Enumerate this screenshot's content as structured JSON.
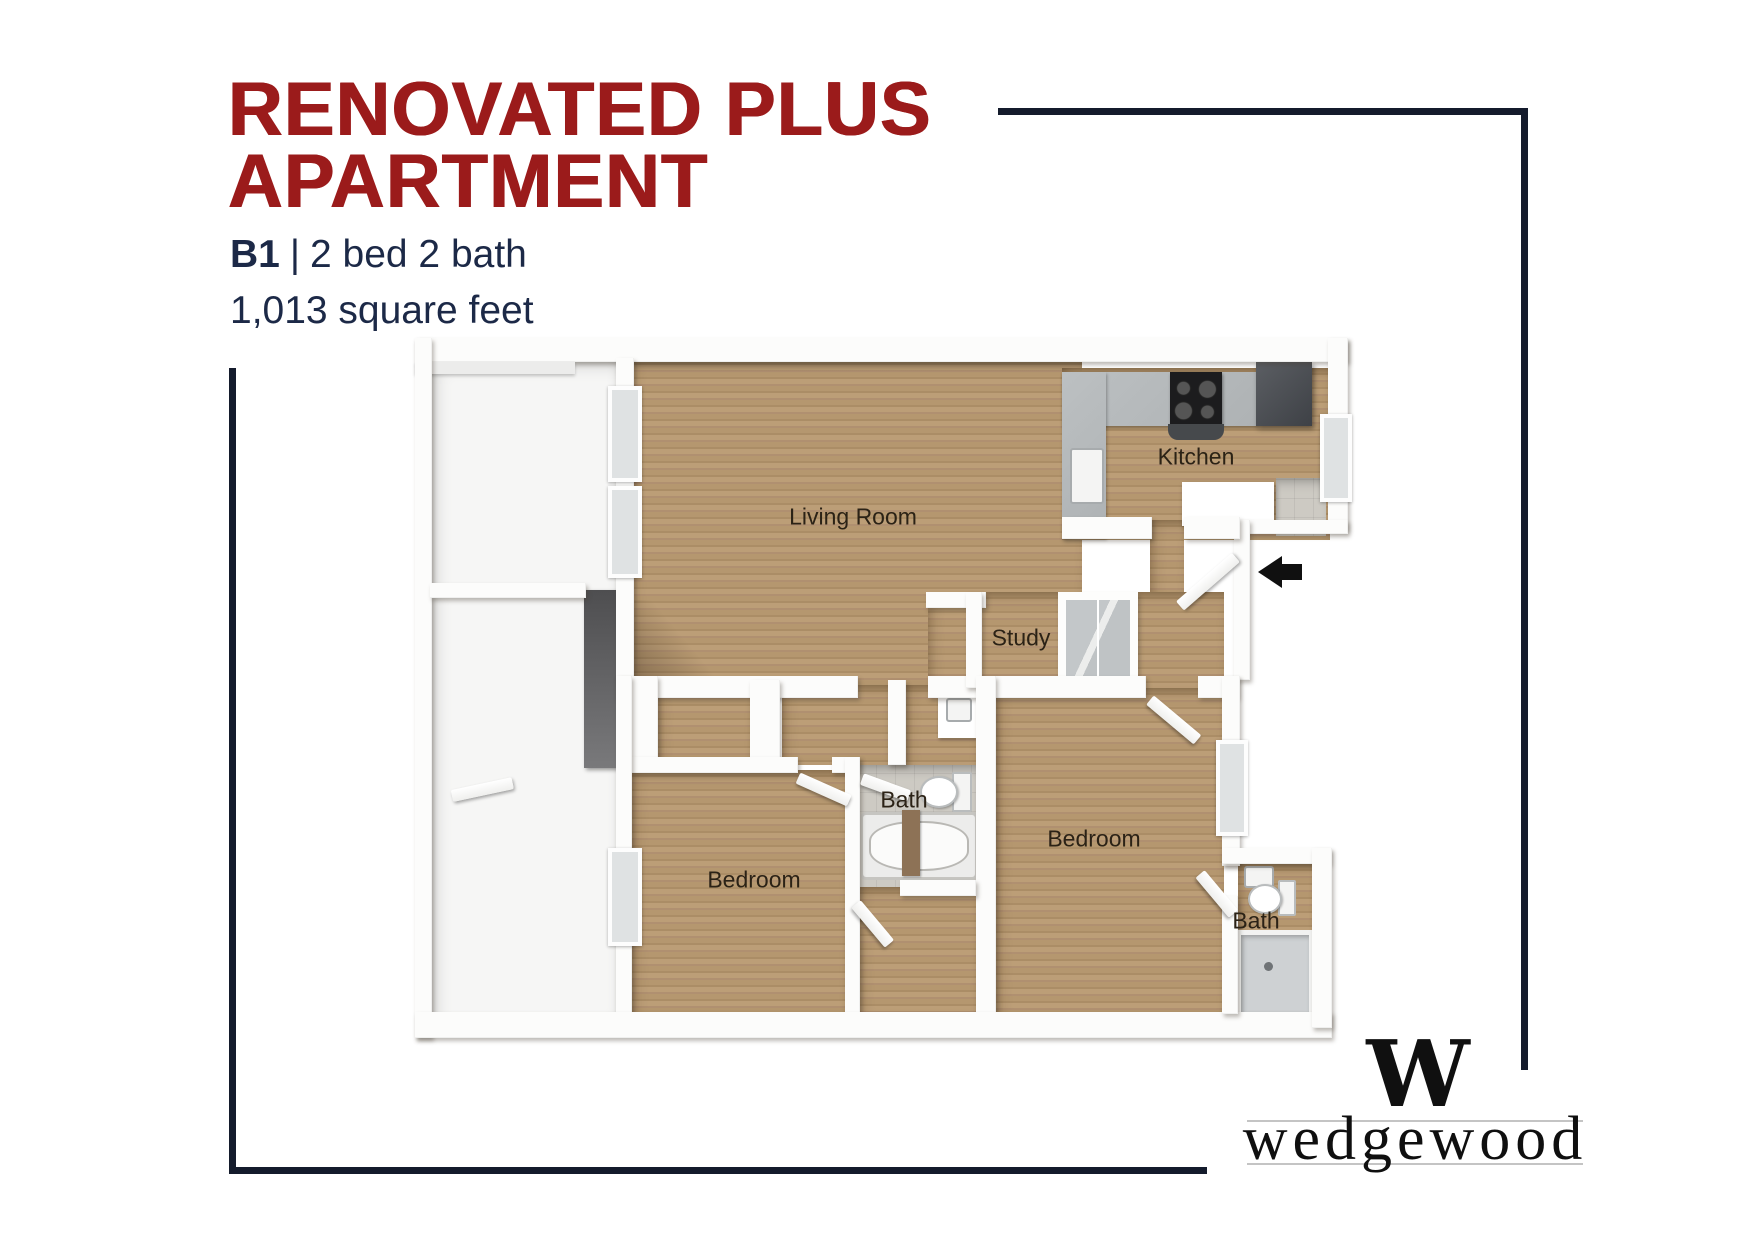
{
  "header": {
    "title_line1": "RENOVATED PLUS",
    "title_line2": "APARTMENT",
    "unit": "B1",
    "divider": "|",
    "beds_baths": "2 bed 2 bath",
    "square_feet": "1,013 square feet"
  },
  "floor_plan": {
    "labels": {
      "living_room": "Living Room",
      "kitchen": "Kitchen",
      "study": "Study",
      "bath_main": "Bath",
      "bedroom_right": "Bedroom",
      "bedroom_left": "Bedroom",
      "bath_ensuite": "Bath"
    },
    "entry_arrow_icon": "left-arrow"
  },
  "branding": {
    "logo_mark": "W",
    "logo_wordmark": "wedgewood"
  },
  "colors": {
    "title_red": "#9B1B1B",
    "navy_text": "#1C2947",
    "frame_navy": "#141B2C",
    "wood_floor": "#B3956F"
  }
}
